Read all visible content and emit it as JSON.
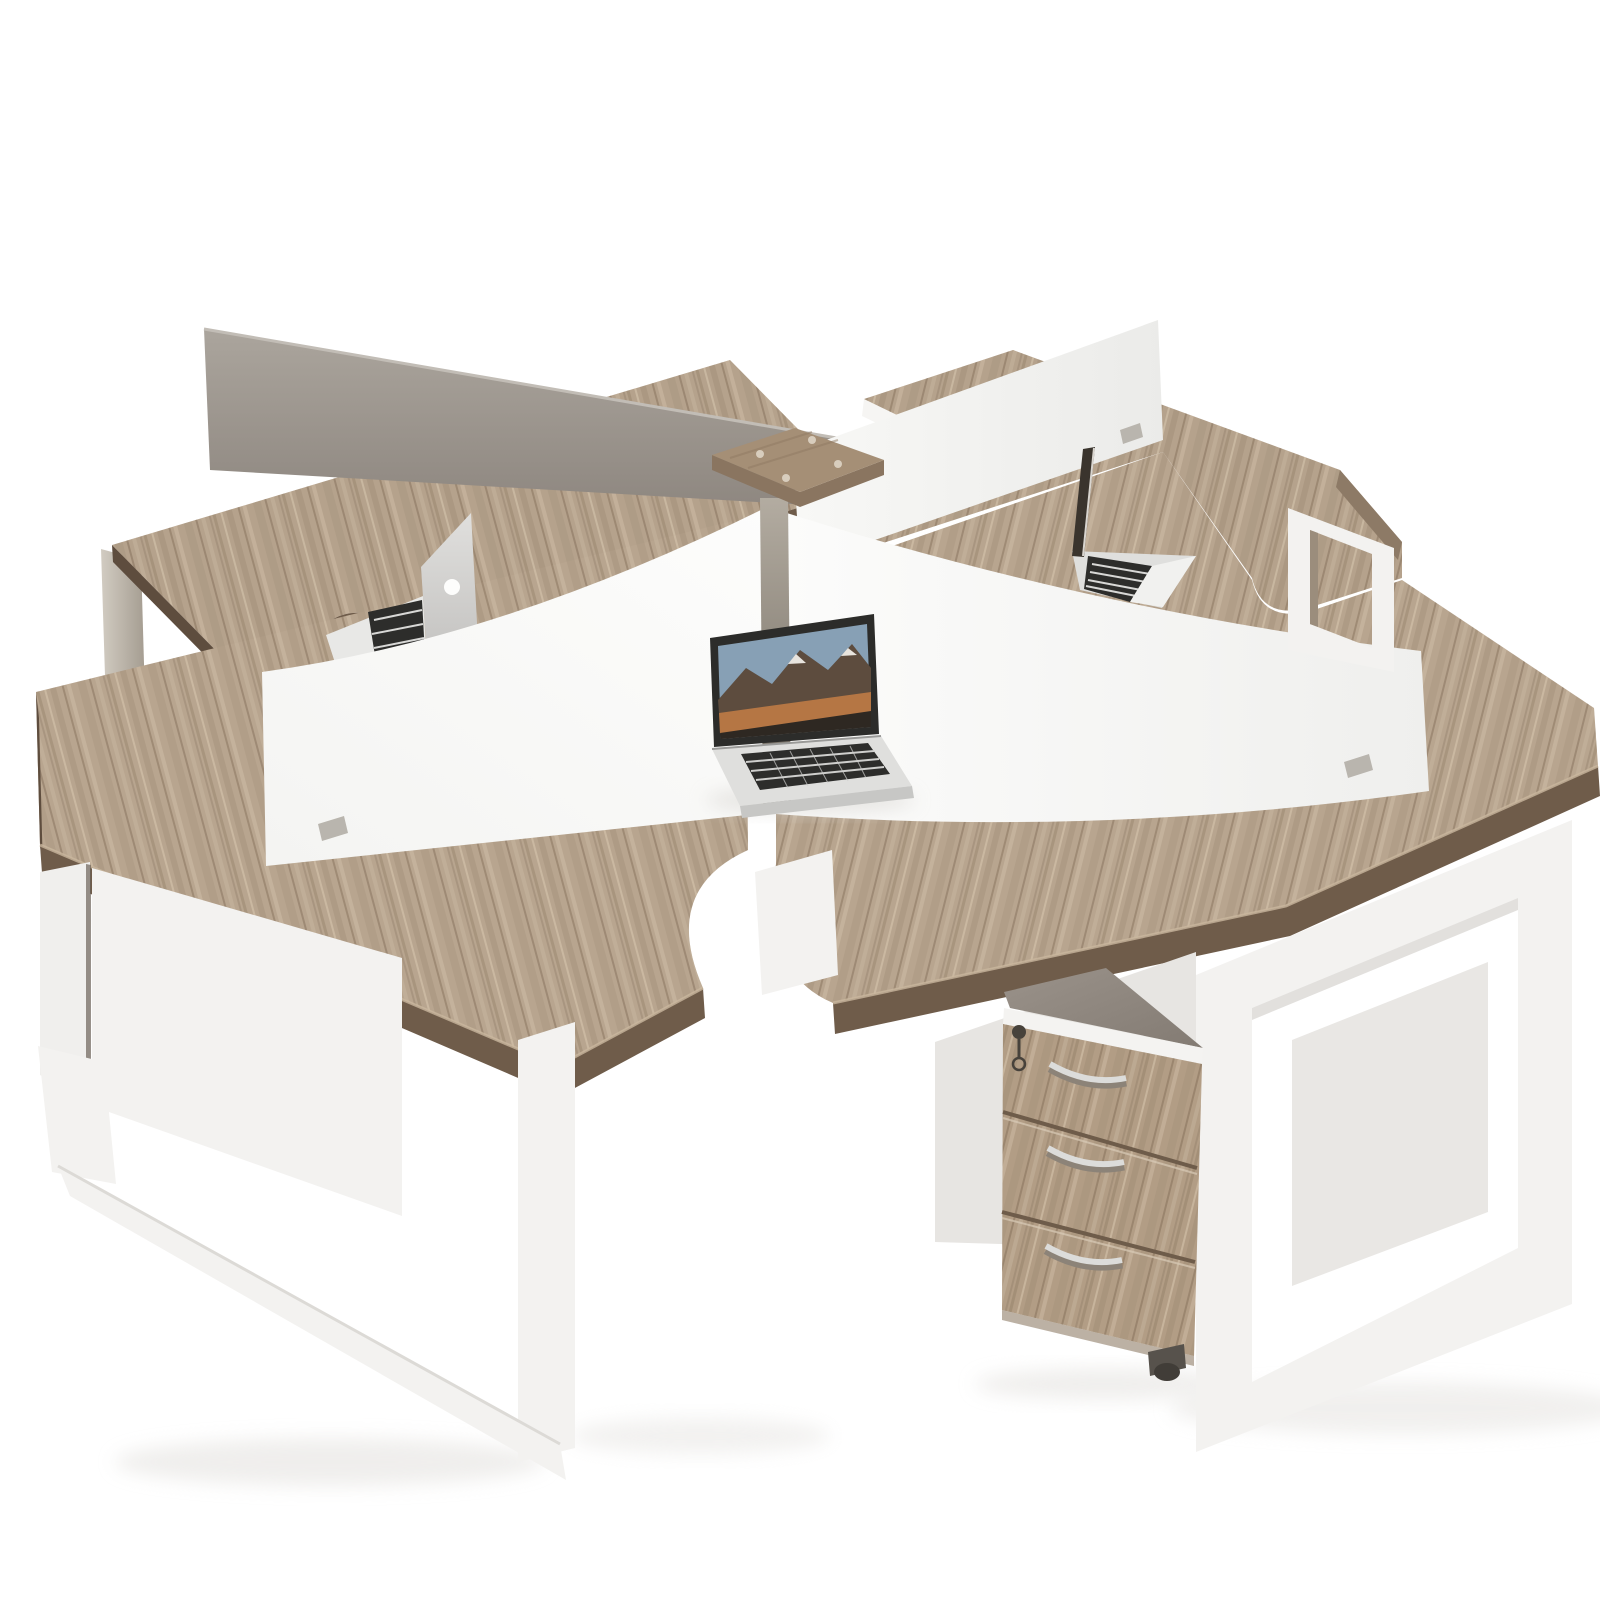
{
  "image": {
    "kind": "product-photo",
    "subject": "4-person X-shaped office workstation desk cluster",
    "description": "Studio render of a four-seat pinwheel workstation: L-shaped light oak desktops, white steel loop legs, white cross privacy dividers with one gray back panel, a central wood connector cap on a steel post, three open MacBooks, and a mobile three-drawer pedestal with silver bow handles, a key lock and a caster."
  },
  "scene": {
    "workstations": 4,
    "divider_panels": {
      "white": 3,
      "gray": 1
    },
    "laptops": [
      {
        "id": "front",
        "style": "open MacBook facing viewer",
        "wallpaper": "mountain landscape"
      },
      {
        "id": "back-left",
        "style": "open MacBook seen from behind, logo visible"
      },
      {
        "id": "back-right",
        "style": "open MacBook seen edge-on"
      }
    ],
    "pedestal": {
      "drawers": 3,
      "handles": "curved silver",
      "has_lock": true,
      "has_key": true,
      "has_caster": true
    },
    "center": {
      "cap": "square wood connector cap",
      "screws": 4,
      "post": "steel column"
    }
  },
  "colors": {
    "bg": "#ffffff",
    "wood": "#b5a28c",
    "woodFront": "#b8a58f",
    "woodEdge": "#6f5c4a",
    "woodEdgeDark": "#5e4d3e",
    "woodEdgeLight": "#c9b69e",
    "woodPedestal": "#b29d85",
    "wallWhite": "#fafaf9",
    "legWhite": "#f3f2f0",
    "legTaupe": "#9b8d7c",
    "modesty": "#f0efed",
    "modestyDim": "#e7e5e2",
    "bezel": "#2c2c2a",
    "sky": "#87a0b5",
    "mountain": "#5d4c3e",
    "orange": "#bd7a44",
    "fgDark": "#2e2822",
    "snow": "#e8e4de",
    "laptopBody": "#dfdfdd",
    "keys": "#2d2d2b",
    "keyLine": "#cfcfcd",
    "capWood": "#a58f76",
    "capSide": "#8a7560",
    "handle": "#dcdcda",
    "handleShadow": "#8c8378",
    "lock": "#47423b",
    "wheel": "#413d38",
    "shadow": "#e3e1de",
    "clip": "#b9b5ae",
    "slit": "#6b6258",
    "whiteEdge": "#f6f5f3"
  }
}
